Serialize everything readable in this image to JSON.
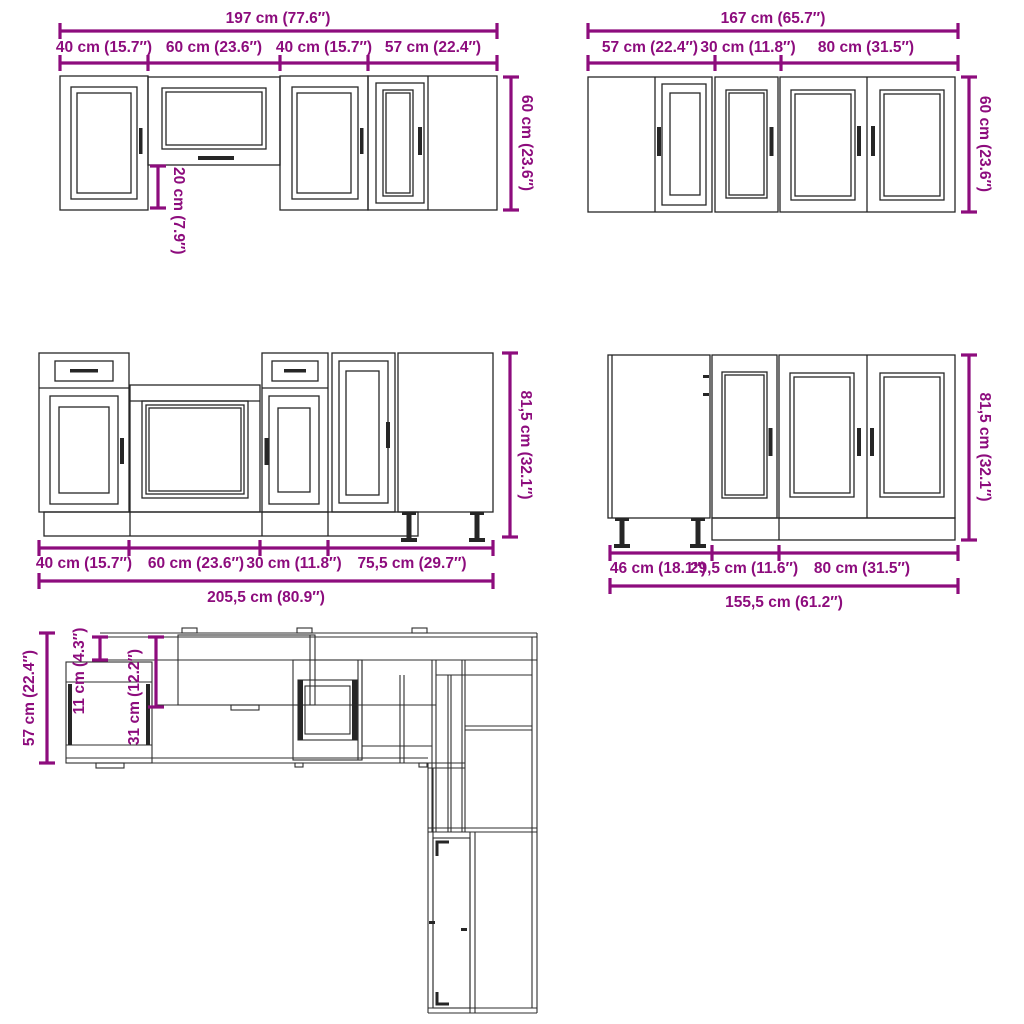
{
  "colors": {
    "dimension": "#8d0c7d",
    "drawing_line": "#262626",
    "background": "#ffffff"
  },
  "wall_run_left": {
    "total": "197 cm (77.6″)",
    "segments": [
      "40 cm (15.7″)",
      "60 cm (23.6″)",
      "40 cm (15.7″)",
      "57 cm (22.4″)"
    ],
    "height": "60 cm (23.6″)",
    "under_cabinet_gap": "20 cm (7.9″)"
  },
  "wall_run_right": {
    "total": "167 cm (65.7″)",
    "segments": [
      "57 cm (22.4″)",
      "30 cm (11.8″)",
      "80 cm (31.5″)"
    ],
    "height": "60 cm (23.6″)"
  },
  "base_run_left": {
    "total": "205,5 cm (80.9″)",
    "segments": [
      "40 cm (15.7″)",
      "60 cm (23.6″)",
      "30 cm (11.8″)",
      "75,5 cm (29.7″)"
    ],
    "height": "81,5 cm (32.1″)"
  },
  "base_run_right": {
    "total": "155,5 cm (61.2″)",
    "segments": [
      "46 cm (18.1″)",
      "29,5 cm (11.6″)",
      "80 cm (31.5″)"
    ],
    "height": "81,5 cm (32.1″)"
  },
  "floor_plan": {
    "total_depth": "57 cm (22.4″)",
    "wall_cabinet_offset": "11 cm (4.3″)",
    "wall_cabinet_depth": "31 cm (12.2″)"
  }
}
